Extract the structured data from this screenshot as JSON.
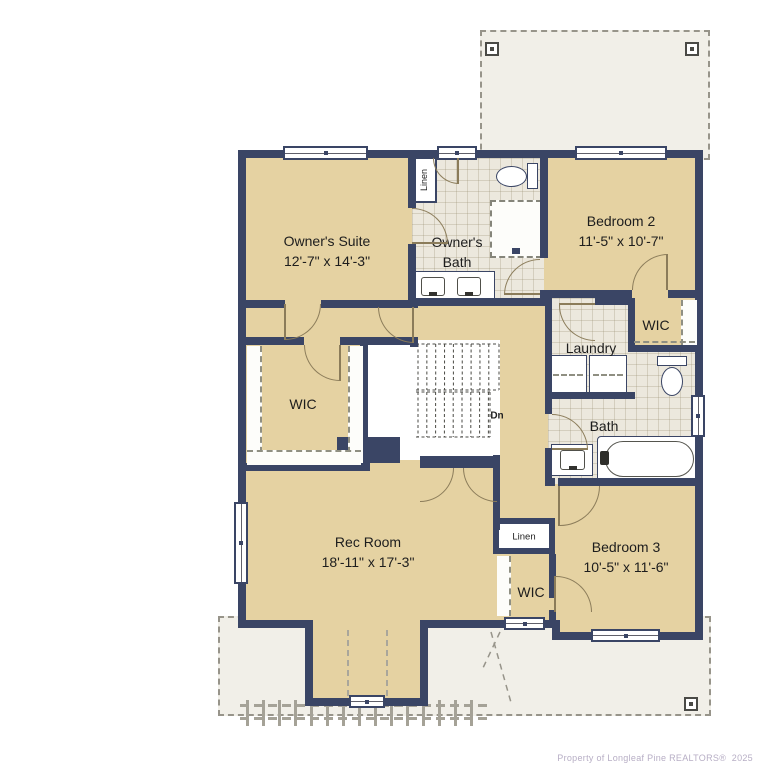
{
  "rooms": {
    "owners_suite": {
      "name": "Owner's Suite",
      "dims": "12'-7\" x 14'-3\""
    },
    "owners_bath": {
      "name": "Owner's Bath"
    },
    "bedroom2": {
      "name": "Bedroom 2",
      "dims": "11'-5\" x 10'-7\""
    },
    "bedroom3": {
      "name": "Bedroom 3",
      "dims": "10'-5\" x 11'-6\""
    },
    "rec_room": {
      "name": "Rec Room",
      "dims": "18'-11\" x 17'-3\""
    },
    "laundry": {
      "name": "Laundry"
    },
    "bath": {
      "name": "Bath"
    },
    "wic_left": {
      "name": "WIC"
    },
    "wic_bedroom2": {
      "name": "WIC"
    },
    "wic_bedroom3": {
      "name": "WIC"
    },
    "linen_bath": {
      "name": "Linen"
    },
    "linen_hall": {
      "name": "Linen"
    },
    "stairs": {
      "down_label": "Dn"
    }
  },
  "watermark": {
    "text": "Property of Longleaf Pine REALTORS®",
    "year": "2025"
  },
  "colors": {
    "wall": "#3a4565",
    "floor": "#e5d2a2",
    "tile": "#ece8dd",
    "roof_dash": "#97948a"
  }
}
